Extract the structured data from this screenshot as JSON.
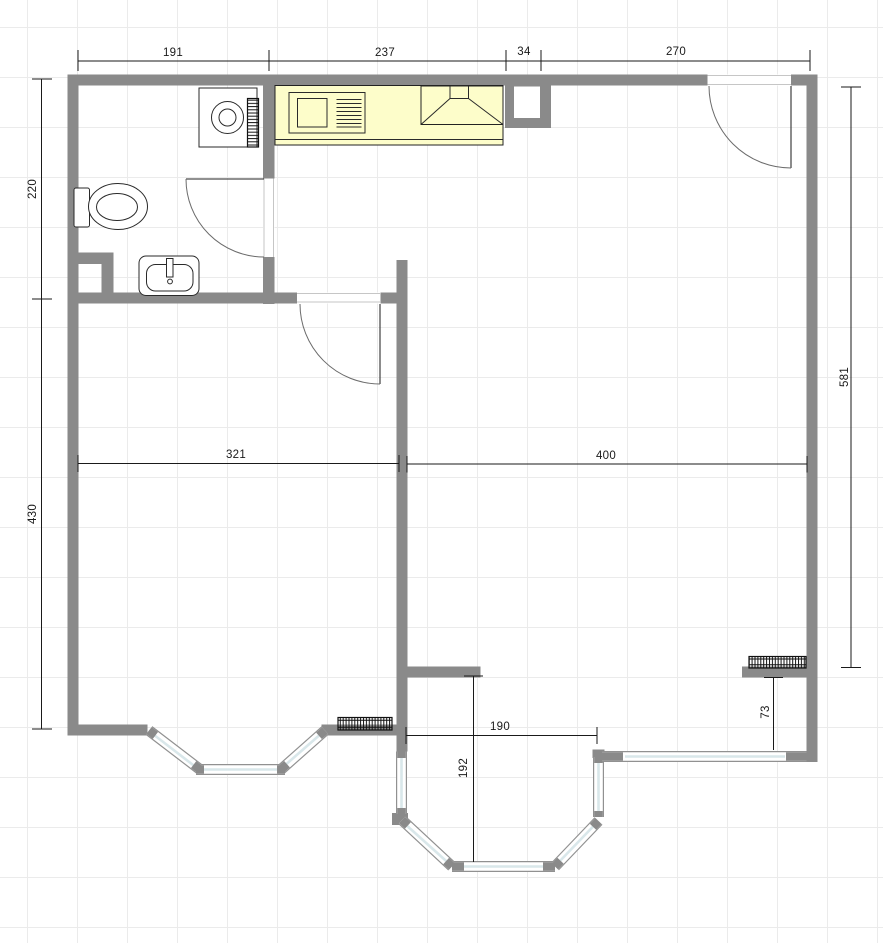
{
  "plan": {
    "type": "floor-plan",
    "dimensions": {
      "t191": "191",
      "t237": "237",
      "t34": "34",
      "t270": "270",
      "l220": "220",
      "l430": "430",
      "r581": "581",
      "m321": "321",
      "m400": "400",
      "b190": "190",
      "r73": "73",
      "b192": "192"
    },
    "fixtures": [
      "washing-machine",
      "towel-radiator",
      "toilet",
      "washbasin",
      "kitchen-counter",
      "kitchen-sink",
      "cooker-hood",
      "wall-niche",
      "radiator-bottom-left",
      "radiator-right",
      "bay-window-left",
      "bay-window-center",
      "window-bottom-right",
      "entry-door",
      "bathroom-door",
      "living-room-door"
    ],
    "colors": {
      "wall": "#8a8a8a",
      "counter": "#fdfdca",
      "window_glass": "#d9e7ea",
      "grid": "#ebebeb",
      "dimension": "#1a1a1a"
    }
  }
}
